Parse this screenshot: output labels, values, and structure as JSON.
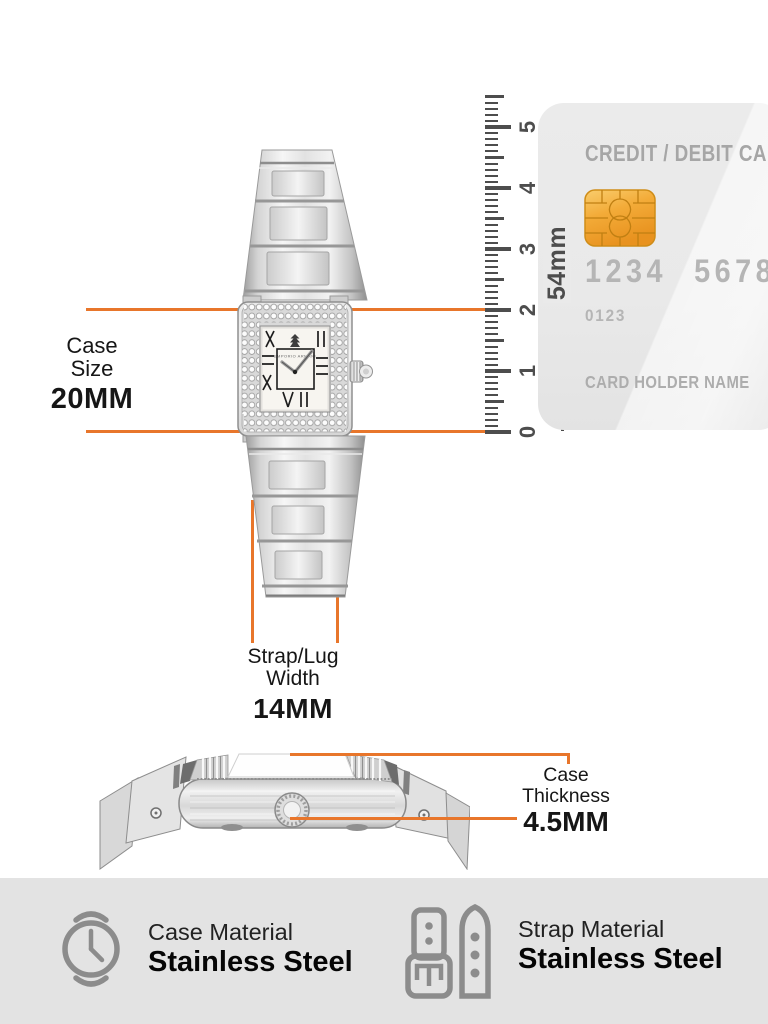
{
  "accent_color": "#E8762B",
  "labels": {
    "case_size": {
      "line1": "Case",
      "line2": "Size",
      "value": "20MM"
    },
    "strap_width": {
      "line1": "Strap/Lug",
      "line2": "Width",
      "value": "14MM"
    },
    "case_thickness": {
      "line1": "Case Thickness",
      "value": "4.5MM"
    }
  },
  "ruler": {
    "tick_labels": [
      "0",
      "1",
      "2",
      "3",
      "4",
      "5"
    ],
    "height_label": "54mm"
  },
  "card": {
    "title": "CREDIT / DEBIT CARD",
    "number_group_1": "1234",
    "number_group_2": "5678",
    "secondary_number": "0123",
    "holder_label": "CARD HOLDER NAME",
    "chip_color": "#F0A32F"
  },
  "watch": {
    "dial_brand": "EMPORIO ARMANI"
  },
  "specs": {
    "case_material": {
      "label": "Case Material",
      "value": "Stainless Steel"
    },
    "strap_material": {
      "label": "Strap Material",
      "value": "Stainless Steel"
    }
  }
}
